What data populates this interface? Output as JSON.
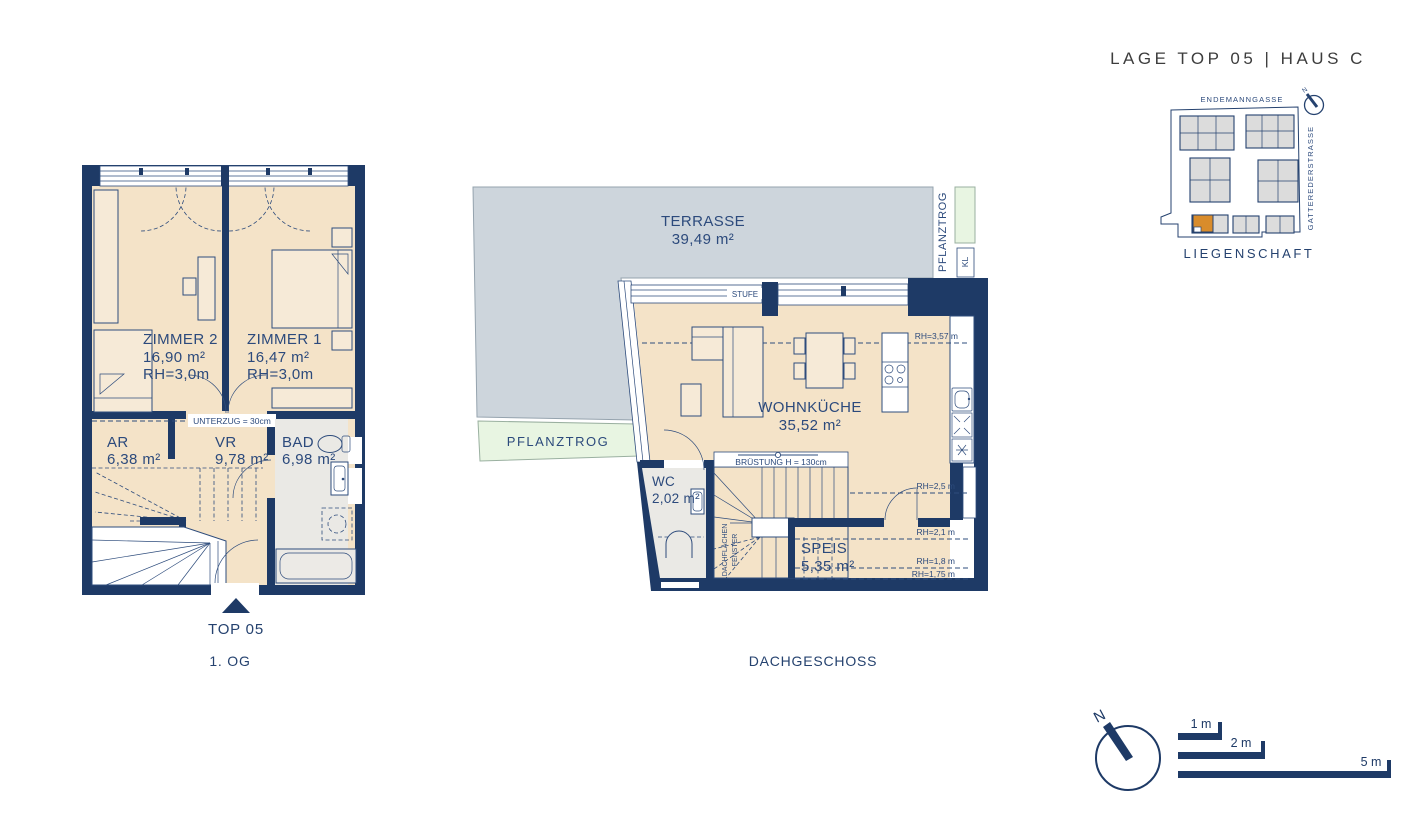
{
  "header": {
    "title": "LAGE TOP 05  |  HAUS C"
  },
  "site_plan": {
    "street_top": "ENDEMANNGASSE",
    "street_right": "GATTEREDERSTRASSE",
    "caption": "LIEGENSCHAFT",
    "north_label": "N",
    "highlight_color": "#d98c2b"
  },
  "floor_1og": {
    "caption": "1. OG",
    "unit_label": "TOP 05",
    "beam_label": "UNTERZUG = 30cm",
    "rooms": {
      "zimmer2": {
        "name": "ZIMMER 2",
        "area": "16,90 m²",
        "rh": "RH=3,0m"
      },
      "zimmer1": {
        "name": "ZIMMER 1",
        "area": "16,47 m²",
        "rh": "RH=3,0m"
      },
      "ar": {
        "name": "AR",
        "area": "6,38 m²"
      },
      "vr": {
        "name": "VR",
        "area": "9,78 m²"
      },
      "bad": {
        "name": "BAD",
        "area": "6,98 m²"
      }
    }
  },
  "floor_dg": {
    "caption": "DACHGESCHOSS",
    "rooms": {
      "terrasse": {
        "name": "TERRASSE",
        "area": "39,49 m²"
      },
      "wohnkueche": {
        "name": "WOHNKÜCHE",
        "area": "35,52 m²"
      },
      "wc": {
        "name": "WC",
        "area": "2,02 m²"
      },
      "speis": {
        "name": "SPEIS",
        "area": "5,35 m²"
      }
    },
    "labels": {
      "stufe": "STUFE",
      "pflanztrog_terrace": "PFLANZTROG",
      "pflanztrog_side": "PFLANZTROG",
      "kl": "KL",
      "bruestung": "BRÜSTUNG H = 130cm",
      "roof_window_line1": "DACHFLÄCHEN",
      "roof_window_line2": "FENSTER",
      "rh_main": "RH=3,57 m",
      "rh_25": "RH=2,5 m",
      "rh_21": "RH=2,1 m",
      "rh_18": "RH=1,8 m",
      "rh_175": "RH=1,75 m"
    }
  },
  "scale_bar": {
    "north_label": "N",
    "items": [
      {
        "label": "1 m"
      },
      {
        "label": "2 m"
      },
      {
        "label": "5 m"
      }
    ]
  },
  "colors": {
    "wall_navy": "#1e3a66",
    "line_navy": "#2e4c7c",
    "floor_beige": "#f4e3c8",
    "terrace_grey": "#cdd5dc",
    "wet_room_grey": "#eae9e5",
    "planter_green": "#e8f5e2",
    "building_grey": "#dcdcdc",
    "highlight_orange": "#d98c2b",
    "header_grey": "#3d3d3d"
  }
}
